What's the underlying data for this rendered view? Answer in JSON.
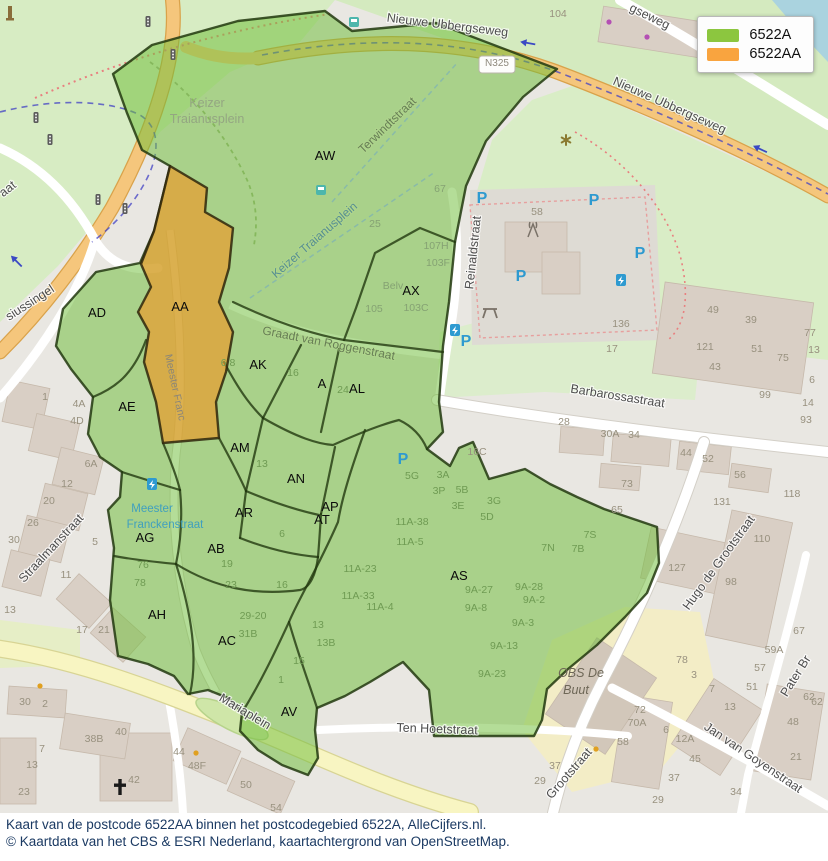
{
  "legend": {
    "items": [
      {
        "label": "6522A",
        "color": "#8cc63f"
      },
      {
        "label": "6522AA",
        "color": "#f9a43f"
      }
    ]
  },
  "caption": {
    "line1": "Kaart van de postcode 6522AA binnen het postcodegebied 6522A, AlleCijfers.nl.",
    "line2": "© Kaartdata van het CBS & ESRI Nederland, kaartachtergrond van OpenStreetMap."
  },
  "colors": {
    "overlay_green": "#6fbe3a",
    "overlay_orange": "#f5921e",
    "overlay_border": "#22380f",
    "water": "#aad3df",
    "road_orange": "#f5c67c",
    "road_yellow": "#f8f5c2",
    "park_green": "#d7ecc3",
    "building": "#d9cfc5"
  },
  "map": {
    "region_labels": [
      {
        "text": "AW",
        "x": 325,
        "y": 160
      },
      {
        "text": "AX",
        "x": 411,
        "y": 295
      },
      {
        "text": "AA",
        "x": 180,
        "y": 311
      },
      {
        "text": "AD",
        "x": 97,
        "y": 317
      },
      {
        "text": "AE",
        "x": 127,
        "y": 411
      },
      {
        "text": "AK",
        "x": 258,
        "y": 369
      },
      {
        "text": "A",
        "x": 322,
        "y": 388
      },
      {
        "text": "AL",
        "x": 357,
        "y": 393
      },
      {
        "text": "AM",
        "x": 240,
        "y": 452
      },
      {
        "text": "AN",
        "x": 296,
        "y": 483
      },
      {
        "text": "AR",
        "x": 244,
        "y": 517
      },
      {
        "text": "AP",
        "x": 330,
        "y": 511
      },
      {
        "text": "AT",
        "x": 322,
        "y": 524
      },
      {
        "text": "AG",
        "x": 145,
        "y": 542
      },
      {
        "text": "AB",
        "x": 216,
        "y": 553
      },
      {
        "text": "AS",
        "x": 459,
        "y": 580
      },
      {
        "text": "AH",
        "x": 157,
        "y": 619
      },
      {
        "text": "AC",
        "x": 227,
        "y": 645
      },
      {
        "text": "AV",
        "x": 289,
        "y": 716
      }
    ],
    "street_labels": [
      {
        "text": "Nieuwe Ubbergseweg",
        "x": 447,
        "y": 29,
        "rotate": 7,
        "size": 13,
        "cls": "street"
      },
      {
        "text": "Nieuwe Ubbergseweg",
        "x": 668,
        "y": 109,
        "rotate": 24,
        "size": 13,
        "cls": "street"
      },
      {
        "text": "gseweg",
        "x": 648,
        "y": 20,
        "rotate": 26,
        "size": 12.5,
        "cls": "street"
      },
      {
        "text": "Terwindtstraat",
        "x": 390,
        "y": 128,
        "rotate": -44,
        "size": 12,
        "cls": "street-green"
      },
      {
        "text": "Keizer Traianusplein",
        "x": 317,
        "y": 243,
        "rotate": -41,
        "size": 12,
        "cls": "street-teal"
      },
      {
        "text": "Reinaldstraat",
        "x": 477,
        "y": 253,
        "rotate": -84,
        "size": 11.5,
        "cls": "street"
      },
      {
        "text": "Graadt van Roggenstraat",
        "x": 328,
        "y": 347,
        "rotate": 11,
        "size": 11,
        "cls": "street-green"
      },
      {
        "text": "Barbarossastraat",
        "x": 617,
        "y": 400,
        "rotate": 9,
        "size": 13,
        "cls": "street"
      },
      {
        "text": "Hugo de Grootstraat",
        "x": 722,
        "y": 565,
        "rotate": -54,
        "size": 13,
        "cls": "street"
      },
      {
        "text": "Grootstraat",
        "x": 572,
        "y": 776,
        "rotate": -49,
        "size": 13,
        "cls": "street"
      },
      {
        "text": "Jan van Goyenstraat",
        "x": 751,
        "y": 761,
        "rotate": 34,
        "size": 13,
        "cls": "street"
      },
      {
        "text": "Ten Hoetstraat",
        "x": 437,
        "y": 733,
        "rotate": 2,
        "size": 12.5,
        "cls": "street"
      },
      {
        "text": "Mariaplein",
        "x": 243,
        "y": 715,
        "rotate": 31,
        "size": 12,
        "cls": "street"
      },
      {
        "text": "Straalmanstraat",
        "x": 54,
        "y": 551,
        "rotate": -47,
        "size": 12.5,
        "cls": "street"
      },
      {
        "text": "siussingel",
        "x": 32,
        "y": 306,
        "rotate": -33,
        "size": 12.5,
        "cls": "street"
      },
      {
        "text": "aat",
        "x": 10,
        "y": 192,
        "rotate": -38,
        "size": 11,
        "cls": "street"
      },
      {
        "text": "Meester Franc",
        "x": 172,
        "y": 388,
        "rotate": 78,
        "size": 10.5,
        "cls": "street-faint"
      },
      {
        "text": "Meester",
        "x": 152,
        "y": 512,
        "rotate": 0,
        "size": 11.5,
        "cls": "street-blue"
      },
      {
        "text": "Franckenstraat",
        "x": 165,
        "y": 528,
        "rotate": 0,
        "size": 11.5,
        "cls": "street-blue"
      },
      {
        "text": "Pater Br",
        "x": 799,
        "y": 678,
        "rotate": -58,
        "size": 12.5,
        "cls": "street"
      }
    ],
    "poi_labels": [
      {
        "text": "Keizer",
        "x": 207,
        "y": 107,
        "cls": "park-name"
      },
      {
        "text": "Traianusplein",
        "x": 207,
        "y": 123,
        "cls": "park-name"
      },
      {
        "text": "OBS De",
        "x": 581,
        "y": 677,
        "cls": "school"
      },
      {
        "text": "Buut",
        "x": 576,
        "y": 694,
        "cls": "school"
      },
      {
        "text": "Belv",
        "x": 393,
        "y": 289,
        "cls": "hn-park"
      },
      {
        "text": "N325",
        "x": 497,
        "y": 66,
        "cls": "badge-text"
      }
    ],
    "house_numbers": [
      {
        "text": "104",
        "x": 558,
        "y": 17
      },
      {
        "text": "58",
        "x": 537,
        "y": 215
      },
      {
        "text": "136",
        "x": 621,
        "y": 327
      },
      {
        "text": "17",
        "x": 612,
        "y": 352
      },
      {
        "text": "49",
        "x": 713,
        "y": 313
      },
      {
        "text": "39",
        "x": 751,
        "y": 323
      },
      {
        "text": "121",
        "x": 705,
        "y": 350
      },
      {
        "text": "51",
        "x": 757,
        "y": 352
      },
      {
        "text": "75",
        "x": 783,
        "y": 361
      },
      {
        "text": "43",
        "x": 715,
        "y": 370
      },
      {
        "text": "99",
        "x": 765,
        "y": 398
      },
      {
        "text": "77",
        "x": 810,
        "y": 336
      },
      {
        "text": "13",
        "x": 814,
        "y": 353
      },
      {
        "text": "6",
        "x": 812,
        "y": 383
      },
      {
        "text": "14",
        "x": 808,
        "y": 406
      },
      {
        "text": "93",
        "x": 806,
        "y": 423
      },
      {
        "text": "28",
        "x": 564,
        "y": 425
      },
      {
        "text": "30A",
        "x": 610,
        "y": 437
      },
      {
        "text": "34",
        "x": 634,
        "y": 438
      },
      {
        "text": "44",
        "x": 686,
        "y": 456
      },
      {
        "text": "52",
        "x": 708,
        "y": 462
      },
      {
        "text": "56",
        "x": 740,
        "y": 478
      },
      {
        "text": "73",
        "x": 627,
        "y": 487
      },
      {
        "text": "65",
        "x": 617,
        "y": 513
      },
      {
        "text": "131",
        "x": 722,
        "y": 505
      },
      {
        "text": "118",
        "x": 792,
        "y": 497
      },
      {
        "text": "110",
        "x": 762,
        "y": 542
      },
      {
        "text": "127",
        "x": 677,
        "y": 571
      },
      {
        "text": "98",
        "x": 731,
        "y": 585
      },
      {
        "text": "67",
        "x": 799,
        "y": 634
      },
      {
        "text": "59A",
        "x": 774,
        "y": 653
      },
      {
        "text": "57",
        "x": 760,
        "y": 671
      },
      {
        "text": "51",
        "x": 752,
        "y": 690
      },
      {
        "text": "78",
        "x": 682,
        "y": 663
      },
      {
        "text": "3",
        "x": 694,
        "y": 678
      },
      {
        "text": "7",
        "x": 712,
        "y": 692
      },
      {
        "text": "62",
        "x": 809,
        "y": 700
      },
      {
        "text": "72",
        "x": 640,
        "y": 713
      },
      {
        "text": "70A",
        "x": 637,
        "y": 726
      },
      {
        "text": "58",
        "x": 623,
        "y": 745
      },
      {
        "text": "6",
        "x": 666,
        "y": 733
      },
      {
        "text": "12A",
        "x": 685,
        "y": 742
      },
      {
        "text": "45",
        "x": 695,
        "y": 762
      },
      {
        "text": "37",
        "x": 674,
        "y": 781
      },
      {
        "text": "29",
        "x": 658,
        "y": 803
      },
      {
        "text": "13",
        "x": 730,
        "y": 710
      },
      {
        "text": "34",
        "x": 736,
        "y": 795
      },
      {
        "text": "48",
        "x": 793,
        "y": 725
      },
      {
        "text": "21",
        "x": 796,
        "y": 760
      },
      {
        "text": "62",
        "x": 817,
        "y": 705
      },
      {
        "text": "37",
        "x": 555,
        "y": 769
      },
      {
        "text": "29",
        "x": 540,
        "y": 784
      },
      {
        "text": "30",
        "x": 25,
        "y": 705
      },
      {
        "text": "2",
        "x": 45,
        "y": 707
      },
      {
        "text": "38B",
        "x": 94,
        "y": 742
      },
      {
        "text": "40",
        "x": 121,
        "y": 735
      },
      {
        "text": "42",
        "x": 134,
        "y": 783
      },
      {
        "text": "44",
        "x": 179,
        "y": 755
      },
      {
        "text": "48F",
        "x": 197,
        "y": 769
      },
      {
        "text": "50",
        "x": 246,
        "y": 788
      },
      {
        "text": "54",
        "x": 276,
        "y": 811
      },
      {
        "text": "7",
        "x": 42,
        "y": 752
      },
      {
        "text": "13",
        "x": 32,
        "y": 768
      },
      {
        "text": "23",
        "x": 24,
        "y": 795
      },
      {
        "text": "1",
        "x": 45,
        "y": 400
      },
      {
        "text": "4A",
        "x": 79,
        "y": 407
      },
      {
        "text": "4D",
        "x": 77,
        "y": 424
      },
      {
        "text": "6A",
        "x": 91,
        "y": 467
      },
      {
        "text": "12",
        "x": 67,
        "y": 487
      },
      {
        "text": "20",
        "x": 49,
        "y": 504
      },
      {
        "text": "26",
        "x": 33,
        "y": 526
      },
      {
        "text": "30",
        "x": 14,
        "y": 543
      },
      {
        "text": "5",
        "x": 95,
        "y": 545
      },
      {
        "text": "11",
        "x": 66,
        "y": 578
      },
      {
        "text": "13",
        "x": 10,
        "y": 613
      },
      {
        "text": "17",
        "x": 82,
        "y": 633
      },
      {
        "text": "21",
        "x": 104,
        "y": 633
      },
      {
        "text": "16C",
        "x": 477,
        "y": 455
      },
      {
        "text": "67",
        "x": 440,
        "y": 192,
        "cls": "hn-park"
      },
      {
        "text": "25",
        "x": 375,
        "y": 227,
        "cls": "hn-park"
      },
      {
        "text": "107H",
        "x": 436,
        "y": 249,
        "cls": "hn-park"
      },
      {
        "text": "103F",
        "x": 438,
        "y": 266,
        "cls": "hn-park"
      },
      {
        "text": "105",
        "x": 374,
        "y": 312,
        "cls": "hn-park"
      },
      {
        "text": "103C",
        "x": 416,
        "y": 311,
        "cls": "hn-park"
      },
      {
        "text": "6 8",
        "x": 228,
        "y": 366,
        "cls": "hn-green"
      },
      {
        "text": "16",
        "x": 293,
        "y": 376,
        "cls": "hn-green"
      },
      {
        "text": "24",
        "x": 343,
        "y": 393,
        "cls": "hn-green"
      },
      {
        "text": "13",
        "x": 262,
        "y": 467,
        "cls": "hn-green"
      },
      {
        "text": "5G",
        "x": 412,
        "y": 479,
        "cls": "hn-green"
      },
      {
        "text": "3A",
        "x": 443,
        "y": 478,
        "cls": "hn-green"
      },
      {
        "text": "3P",
        "x": 439,
        "y": 494,
        "cls": "hn-green"
      },
      {
        "text": "5B",
        "x": 462,
        "y": 493,
        "cls": "hn-green"
      },
      {
        "text": "3E",
        "x": 458,
        "y": 509,
        "cls": "hn-green"
      },
      {
        "text": "3G",
        "x": 494,
        "y": 504,
        "cls": "hn-green"
      },
      {
        "text": "5D",
        "x": 487,
        "y": 520,
        "cls": "hn-green"
      },
      {
        "text": "11A-38",
        "x": 412,
        "y": 525,
        "cls": "hn-green"
      },
      {
        "text": "11A-5",
        "x": 410,
        "y": 545,
        "cls": "hn-green"
      },
      {
        "text": "11A-23",
        "x": 360,
        "y": 572,
        "cls": "hn-green"
      },
      {
        "text": "11A-33",
        "x": 358,
        "y": 599,
        "cls": "hn-green"
      },
      {
        "text": "11A-4",
        "x": 380,
        "y": 610,
        "cls": "hn-green"
      },
      {
        "text": "7S",
        "x": 590,
        "y": 538,
        "cls": "hn-green"
      },
      {
        "text": "7N",
        "x": 548,
        "y": 551,
        "cls": "hn-green"
      },
      {
        "text": "7B",
        "x": 578,
        "y": 552,
        "cls": "hn-green"
      },
      {
        "text": "9A-27",
        "x": 479,
        "y": 593,
        "cls": "hn-green"
      },
      {
        "text": "9A-28",
        "x": 529,
        "y": 590,
        "cls": "hn-green"
      },
      {
        "text": "9A-2",
        "x": 534,
        "y": 603,
        "cls": "hn-green"
      },
      {
        "text": "9A-8",
        "x": 476,
        "y": 611,
        "cls": "hn-green"
      },
      {
        "text": "9A-3",
        "x": 523,
        "y": 626,
        "cls": "hn-green"
      },
      {
        "text": "9A-13",
        "x": 504,
        "y": 649,
        "cls": "hn-green"
      },
      {
        "text": "9A-23",
        "x": 492,
        "y": 677,
        "cls": "hn-green"
      },
      {
        "text": "19",
        "x": 227,
        "y": 567,
        "cls": "hn-green"
      },
      {
        "text": "23",
        "x": 231,
        "y": 588,
        "cls": "hn-green"
      },
      {
        "text": "16",
        "x": 282,
        "y": 588,
        "cls": "hn-green"
      },
      {
        "text": "29-20",
        "x": 253,
        "y": 619,
        "cls": "hn-green"
      },
      {
        "text": "31B",
        "x": 248,
        "y": 637,
        "cls": "hn-green"
      },
      {
        "text": "76",
        "x": 143,
        "y": 568,
        "cls": "hn-green"
      },
      {
        "text": "78",
        "x": 140,
        "y": 586,
        "cls": "hn-green"
      },
      {
        "text": "6",
        "x": 282,
        "y": 537,
        "cls": "hn-green"
      },
      {
        "text": "13",
        "x": 318,
        "y": 628,
        "cls": "hn-green"
      },
      {
        "text": "13B",
        "x": 326,
        "y": 646,
        "cls": "hn-green"
      },
      {
        "text": "15",
        "x": 299,
        "y": 664,
        "cls": "hn-green"
      },
      {
        "text": "1",
        "x": 281,
        "y": 683,
        "cls": "hn-green"
      }
    ],
    "icons": [
      {
        "name": "parking-icon",
        "x": 482,
        "y": 198
      },
      {
        "name": "parking-icon",
        "x": 594,
        "y": 200
      },
      {
        "name": "parking-icon",
        "x": 640,
        "y": 253
      },
      {
        "name": "parking-icon",
        "x": 521,
        "y": 276
      },
      {
        "name": "parking-icon",
        "x": 466,
        "y": 341
      },
      {
        "name": "parking-icon",
        "x": 403,
        "y": 459
      },
      {
        "name": "ev-charger-icon",
        "x": 455,
        "y": 330
      },
      {
        "name": "ev-charger-icon",
        "x": 621,
        "y": 280
      },
      {
        "name": "ev-charger-icon",
        "x": 152,
        "y": 484
      },
      {
        "name": "bus-stop-icon",
        "x": 354,
        "y": 22
      },
      {
        "name": "bus-stop-icon",
        "x": 321,
        "y": 190
      },
      {
        "name": "traffic-light-icon",
        "x": 36,
        "y": 118
      },
      {
        "name": "traffic-light-icon",
        "x": 50,
        "y": 140
      },
      {
        "name": "traffic-light-icon",
        "x": 98,
        "y": 200
      },
      {
        "name": "traffic-light-icon",
        "x": 125,
        "y": 209
      },
      {
        "name": "traffic-light-icon",
        "x": 148,
        "y": 22
      },
      {
        "name": "traffic-light-icon",
        "x": 173,
        "y": 55
      },
      {
        "name": "antenna-icon",
        "x": 533,
        "y": 230
      },
      {
        "name": "picnic-table-icon",
        "x": 490,
        "y": 312
      },
      {
        "name": "church-cross-icon",
        "x": 120,
        "y": 788
      },
      {
        "name": "flower-icon",
        "x": 566,
        "y": 140
      },
      {
        "name": "oneway-arrow-icon",
        "x": 528,
        "y": 44,
        "rotate": 190
      },
      {
        "name": "oneway-arrow-icon",
        "x": 760,
        "y": 150,
        "rotate": 205
      },
      {
        "name": "oneway-arrow-icon",
        "x": 16,
        "y": 262,
        "rotate": 225
      },
      {
        "name": "monument-icon",
        "x": 10,
        "y": 14
      },
      {
        "name": "tree-icon",
        "x": 609,
        "y": 22
      },
      {
        "name": "tree-icon",
        "x": 647,
        "y": 37
      },
      {
        "name": "poi-dot-icon",
        "x": 40,
        "y": 686
      },
      {
        "name": "poi-dot-icon",
        "x": 196,
        "y": 753
      },
      {
        "name": "poi-dot-icon",
        "x": 596,
        "y": 749
      }
    ]
  }
}
